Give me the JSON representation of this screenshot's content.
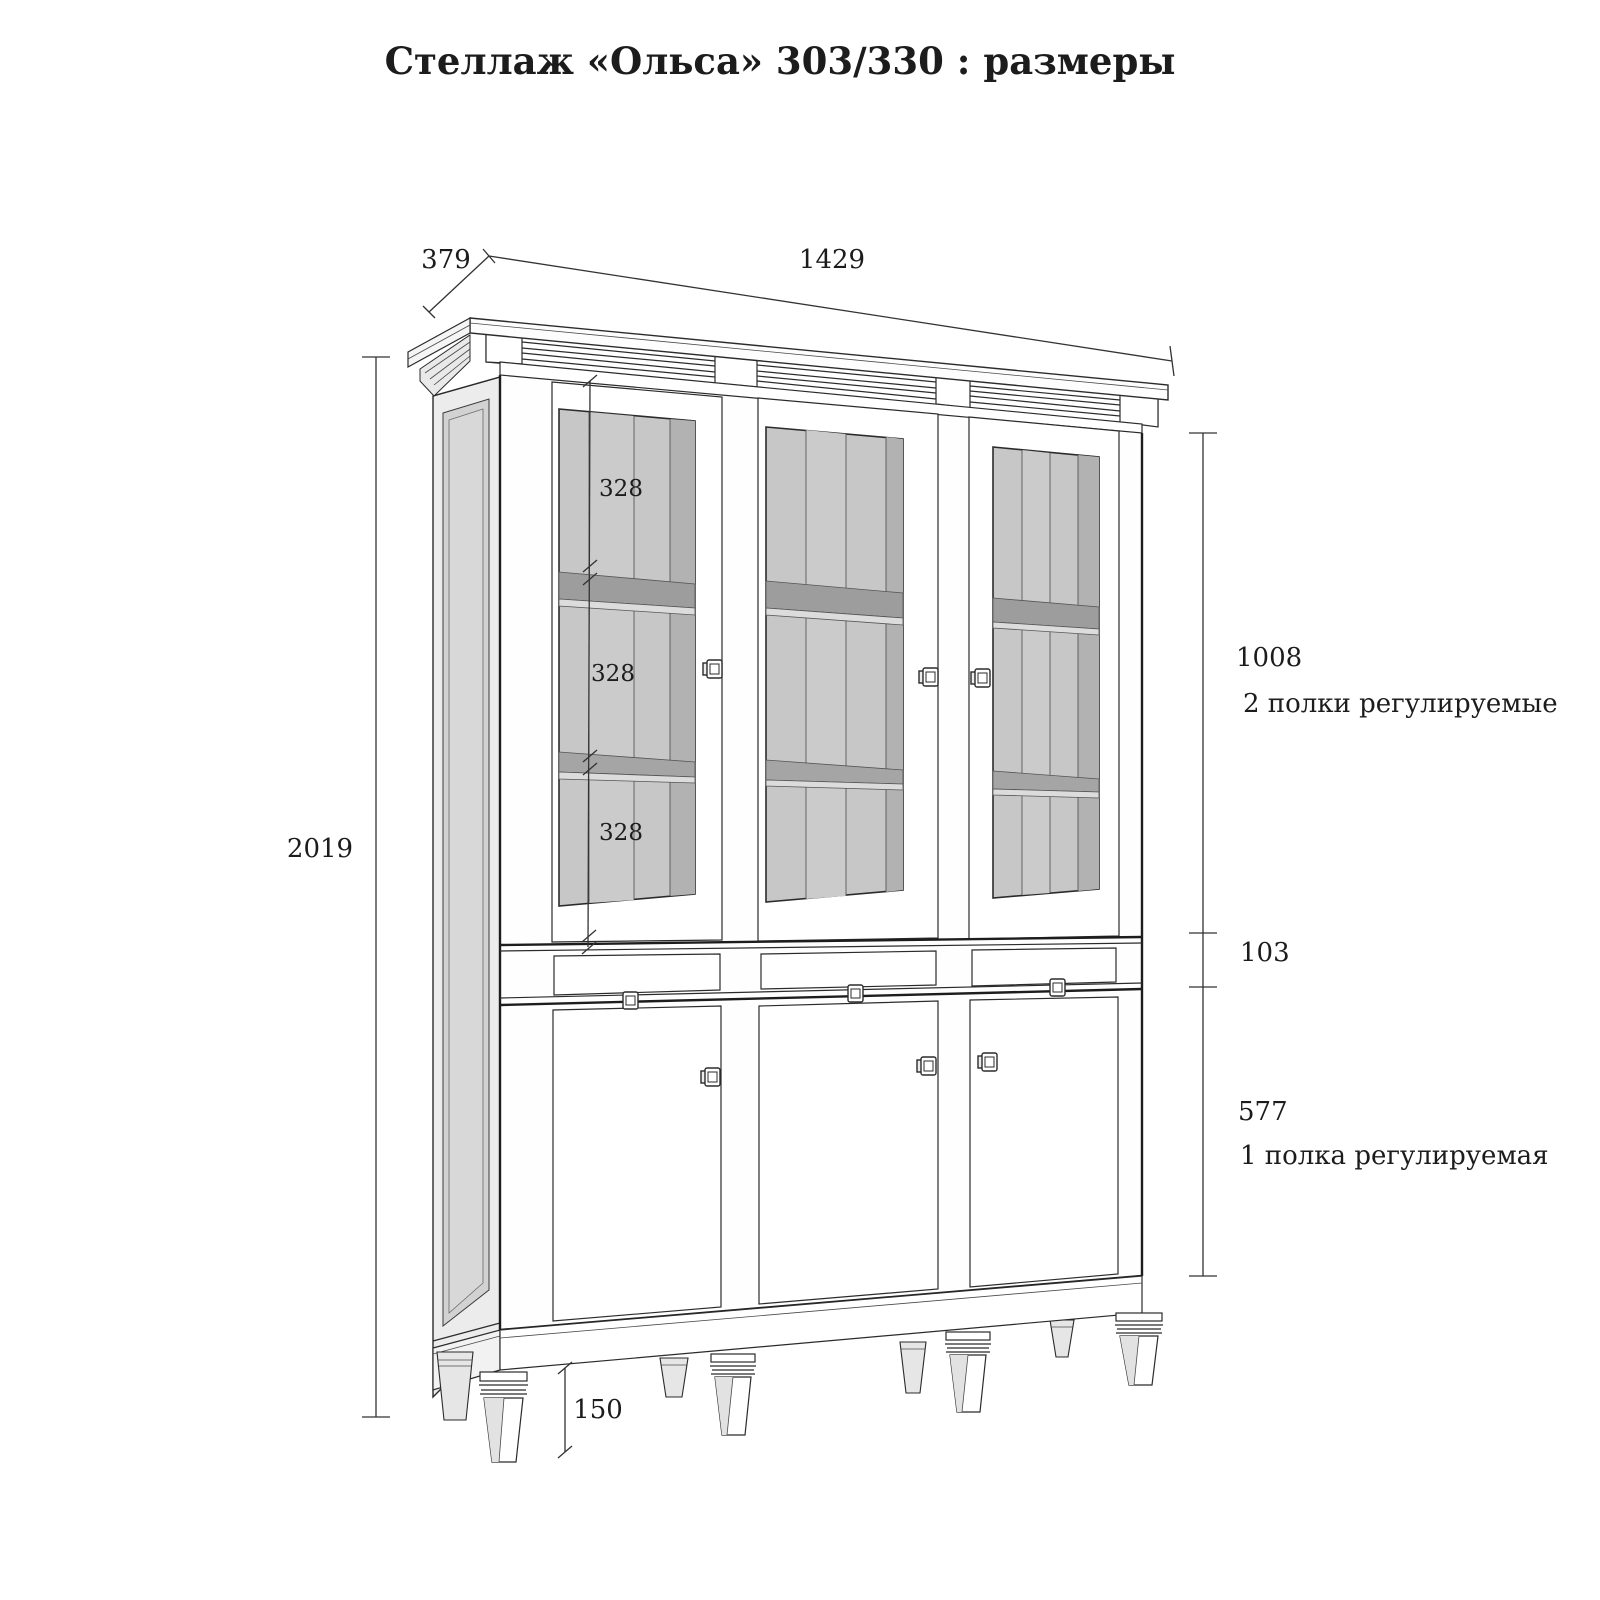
{
  "title": "Стеллаж «Ольса» 303/330 : размеры",
  "overall": {
    "depth": "379",
    "width": "1429",
    "height": "2019",
    "leg_height": "150"
  },
  "sections": {
    "upper_height": "1008",
    "upper_note": "2 полки регулируемые",
    "drawer_height": "103",
    "lower_height": "577",
    "lower_note": "1 полка регулируемая"
  },
  "shelf_gaps": {
    "gap1": "328",
    "gap2": "328",
    "gap3": "328"
  },
  "colors": {
    "line": "#2b2b2b",
    "glass": "#c7c7c7",
    "glass_light": "#cbcbcb",
    "glass_dark": "#b2b2b2",
    "shelf": "#9d9d9d",
    "side_panel": "#d2d2d2"
  }
}
